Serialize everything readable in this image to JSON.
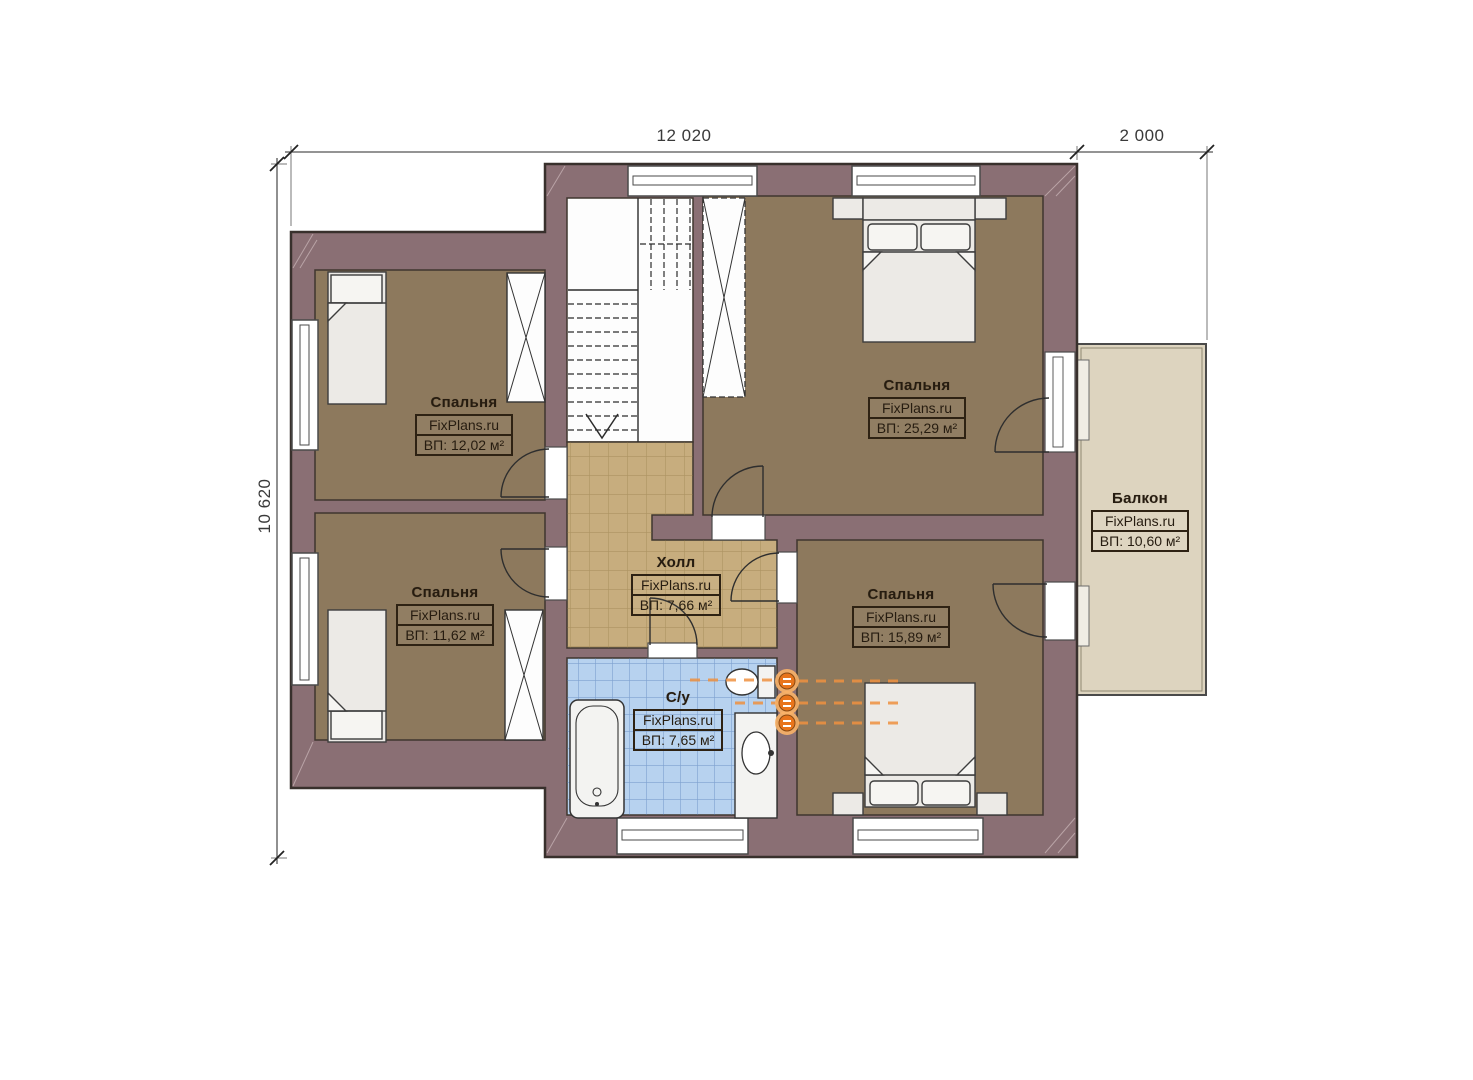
{
  "dimensions": {
    "width_main": "12 020",
    "width_balcony": "2 000",
    "height": "10 620"
  },
  "rooms": {
    "bedroom_tl": {
      "name": "Спальня",
      "brand": "FixPlans.ru",
      "area": "ВП: 12,02 м²"
    },
    "bedroom_tr": {
      "name": "Спальня",
      "brand": "FixPlans.ru",
      "area": "ВП: 25,29 м²"
    },
    "bedroom_bl": {
      "name": "Спальня",
      "brand": "FixPlans.ru",
      "area": "ВП: 11,62 м²"
    },
    "bedroom_br": {
      "name": "Спальня",
      "brand": "FixPlans.ru",
      "area": "ВП: 15,89 м²"
    },
    "hall": {
      "name": "Холл",
      "brand": "FixPlans.ru",
      "area": "ВП: 7,66 м²"
    },
    "bathroom": {
      "name": "С/у",
      "brand": "FixPlans.ru",
      "area": "ВП: 7,65 м²"
    },
    "balcony": {
      "name": "Балкон",
      "brand": "FixPlans.ru",
      "area": "ВП: 10,60 м²"
    }
  },
  "colors": {
    "wall": "#8a6f74",
    "bedroom_floor": "#8d795d",
    "hall_floor": "#c7ad7e",
    "bathroom_floor": "#b7d2ef",
    "balcony_floor": "#ddd4bf",
    "furniture": "#eceae6",
    "riser_orange": "#e8751c",
    "line_dark": "#3a332d"
  }
}
